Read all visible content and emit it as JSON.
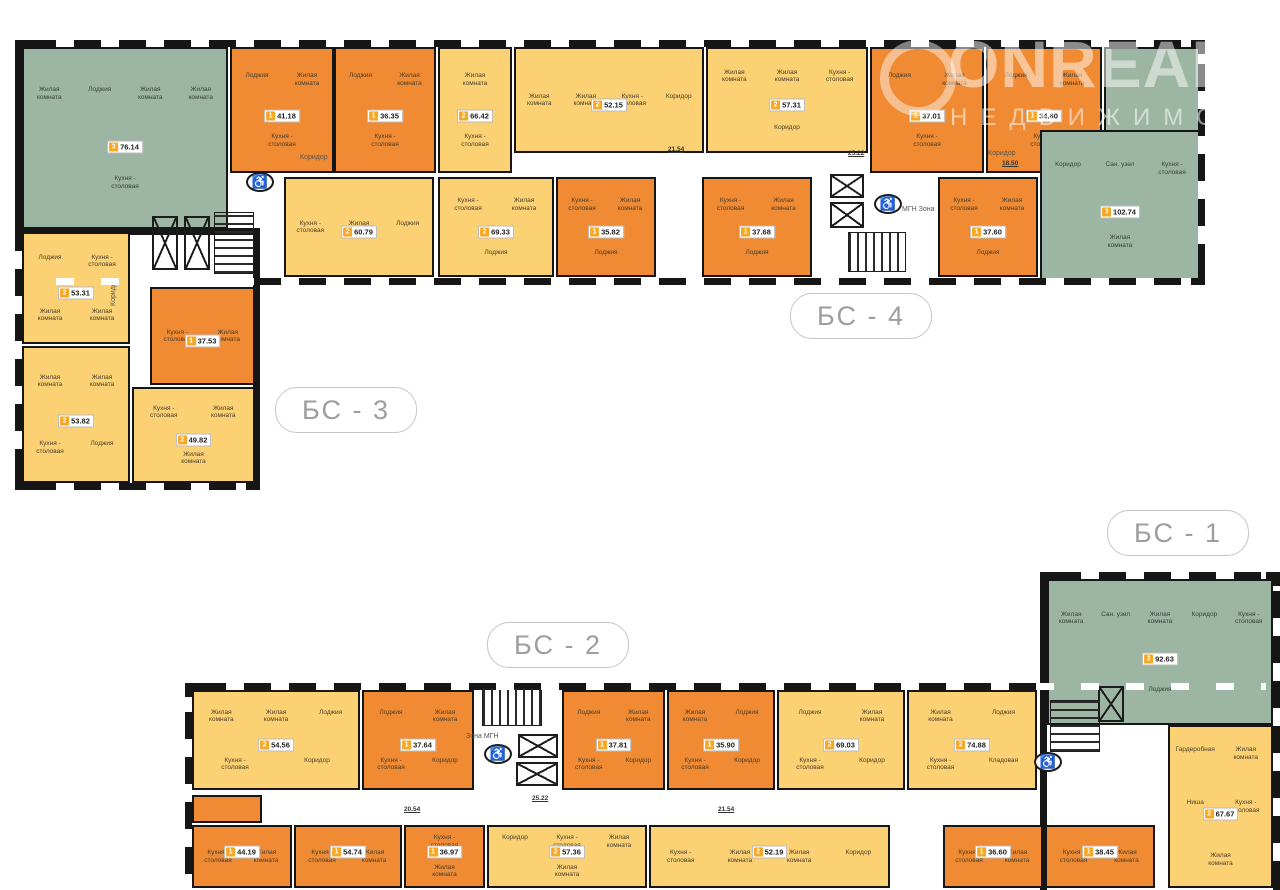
{
  "watermark": {
    "line1": "ONREALT",
    "line2": "НЕДВИЖИМОСТЬ"
  },
  "sections": [
    {
      "id": "bs4",
      "label": "БС - 4"
    },
    {
      "id": "bs3",
      "label": "БС - 3"
    },
    {
      "id": "bs2",
      "label": "БС - 2"
    },
    {
      "id": "bs1",
      "label": "БС - 1"
    }
  ],
  "colors": {
    "one_room": "#f08b33",
    "two_room": "#fcd173",
    "three_room": "#9db5a3",
    "wall": "#161616",
    "badge_square": "#f7a823"
  },
  "apartments": [
    {
      "id": "a7614",
      "section": "БС-3",
      "rooms_count": "3",
      "area": "76.14",
      "type": "three_room",
      "rooms": [
        "Жилая комната",
        "Лоджия",
        "Жилая комната",
        "Жилая комната",
        "Кухня - столовая"
      ]
    },
    {
      "id": "a4118",
      "section": "БС-4",
      "rooms_count": "1",
      "area": "41.18",
      "type": "one_room",
      "rooms": [
        "Лоджия",
        "Жилая комната",
        "Кухня - столовая"
      ]
    },
    {
      "id": "a3635",
      "section": "БС-4",
      "rooms_count": "1",
      "area": "36.35",
      "type": "one_room",
      "rooms": [
        "Лоджия",
        "Жилая комната",
        "Кухня - столовая"
      ]
    },
    {
      "id": "a6642",
      "section": "БС-4",
      "rooms_count": "2",
      "area": "66.42",
      "type": "two_room",
      "rooms": [
        "Жилая комната",
        "Кухня - столовая"
      ]
    },
    {
      "id": "a5215",
      "section": "БС-4",
      "rooms_count": "2",
      "area": "52.15",
      "type": "two_room",
      "rooms": [
        "Жилая комната",
        "Жилая комната",
        "Кухня - столовая",
        "Коридор"
      ]
    },
    {
      "id": "a5731",
      "section": "БС-4",
      "rooms_count": "2",
      "area": "57.31",
      "type": "two_room",
      "rooms": [
        "Жилая комната",
        "Жилая комната",
        "Кухня - столовая",
        "Коридор"
      ]
    },
    {
      "id": "a3701",
      "section": "БС-4",
      "rooms_count": "1",
      "area": "37.01",
      "type": "one_room",
      "rooms": [
        "Лоджия",
        "Жилая комната",
        "Кухня - столовая"
      ]
    },
    {
      "id": "a3460",
      "section": "БС-4",
      "rooms_count": "1",
      "area": "34.60",
      "type": "one_room",
      "rooms": [
        "Лоджия",
        "Жилая комната",
        "Кухня - столовая"
      ]
    },
    {
      "id": "a10274",
      "section": "БС-4",
      "rooms_count": "3",
      "area": "102.74",
      "type": "three_room",
      "rooms": [
        "Коридор",
        "Сан. узел",
        "Кухня - столовая",
        "Жилая комната"
      ]
    },
    {
      "id": "a6079",
      "section": "БС-4",
      "rooms_count": "2",
      "area": "60.79",
      "type": "two_room",
      "rooms": [
        "Кухня - столовая",
        "Жилая комната",
        "Лоджия"
      ]
    },
    {
      "id": "a6933",
      "section": "БС-4",
      "rooms_count": "2",
      "area": "69.33",
      "type": "two_room",
      "rooms": [
        "Кухня - столовая",
        "Жилая комната",
        "Лоджия"
      ]
    },
    {
      "id": "a3582",
      "section": "БС-4",
      "rooms_count": "1",
      "area": "35.82",
      "type": "one_room",
      "rooms": [
        "Кухня - столовая",
        "Жилая комната",
        "Лоджия"
      ]
    },
    {
      "id": "a3768",
      "section": "БС-4",
      "rooms_count": "1",
      "area": "37.68",
      "type": "one_room",
      "rooms": [
        "Кухня - столовая",
        "Жилая комната",
        "Лоджия"
      ]
    },
    {
      "id": "a3760",
      "section": "БС-4",
      "rooms_count": "1",
      "area": "37.60",
      "type": "one_room",
      "rooms": [
        "Кухня - столовая",
        "Жилая комната",
        "Лоджия"
      ]
    },
    {
      "id": "a5331",
      "section": "БС-3",
      "rooms_count": "2",
      "area": "53.31",
      "type": "two_room",
      "rooms": [
        "Лоджия",
        "Кухня - столовая",
        "Жилая комната",
        "Жилая комната"
      ]
    },
    {
      "id": "a3753",
      "section": "БС-3",
      "rooms_count": "1",
      "area": "37.53",
      "type": "one_room",
      "rooms": [
        "Кухня - столовая",
        "Жилая комната"
      ]
    },
    {
      "id": "a5382",
      "section": "БС-3",
      "rooms_count": "2",
      "area": "53.82",
      "type": "two_room",
      "rooms": [
        "Жилая комната",
        "Жилая комната",
        "Кухня - столовая",
        "Лоджия"
      ]
    },
    {
      "id": "a4982",
      "section": "БС-3",
      "rooms_count": "2",
      "area": "49.82",
      "type": "two_room",
      "rooms": [
        "Кухня - столовая",
        "Жилая комната",
        "Жилая комната"
      ]
    },
    {
      "id": "a5456",
      "section": "БС-2",
      "rooms_count": "2",
      "area": "54.56",
      "type": "two_room",
      "rooms": [
        "Жилая комната",
        "Жилая комната",
        "Лоджия",
        "Кухня - столовая",
        "Коридор"
      ]
    },
    {
      "id": "a3764",
      "section": "БС-2",
      "rooms_count": "1",
      "area": "37.64",
      "type": "one_room",
      "rooms": [
        "Лоджия",
        "Жилая комната",
        "Кухня - столовая",
        "Коридор"
      ]
    },
    {
      "id": "a3781",
      "section": "БС-2",
      "rooms_count": "1",
      "area": "37.81",
      "type": "one_room",
      "rooms": [
        "Лоджия",
        "Жилая комната",
        "Кухня - столовая",
        "Коридор"
      ]
    },
    {
      "id": "a3590",
      "section": "БС-2",
      "rooms_count": "1",
      "area": "35.90",
      "type": "one_room",
      "rooms": [
        "Жилая комната",
        "Лоджия",
        "Кухня - столовая",
        "Коридор"
      ]
    },
    {
      "id": "a6903",
      "section": "БС-2",
      "rooms_count": "2",
      "area": "69.03",
      "type": "two_room",
      "rooms": [
        "Лоджия",
        "Жилая комната",
        "Кухня - столовая",
        "Коридор"
      ]
    },
    {
      "id": "a7488",
      "section": "БС-2",
      "rooms_count": "2",
      "area": "74.88",
      "type": "two_room",
      "rooms": [
        "Жилая комната",
        "Лоджия",
        "Кухня - столовая",
        "Кладовая"
      ]
    },
    {
      "id": "a4419",
      "section": "БС-2",
      "rooms_count": "1",
      "area": "44.19",
      "type": "one_room",
      "rooms": [
        "Кухня - столовая",
        "Жилая комната"
      ]
    },
    {
      "id": "a5474",
      "section": "БС-2",
      "rooms_count": "1",
      "area": "54.74",
      "type": "one_room",
      "rooms": [
        "Кухня - столовая",
        "Жилая комната"
      ]
    },
    {
      "id": "a3697",
      "section": "БС-2",
      "rooms_count": "1",
      "area": "36.97",
      "type": "one_room",
      "rooms": [
        "Кухня - столовая",
        "Жилая комната"
      ]
    },
    {
      "id": "a5736",
      "section": "БС-2",
      "rooms_count": "2",
      "area": "57.36",
      "type": "two_room",
      "rooms": [
        "Коридор",
        "Кухня - столовая",
        "Жилая комната",
        "Жилая комната"
      ]
    },
    {
      "id": "a5219",
      "section": "БС-2",
      "rooms_count": "2",
      "area": "52.19",
      "type": "two_room",
      "rooms": [
        "Кухня - столовая",
        "Жилая комната",
        "Жилая комната",
        "Коридор"
      ]
    },
    {
      "id": "a3660",
      "section": "БС-2",
      "rooms_count": "1",
      "area": "36.60",
      "type": "one_room",
      "rooms": [
        "Кухня - столовая",
        "Жилая комната"
      ]
    },
    {
      "id": "a3845",
      "section": "БС-2",
      "rooms_count": "1",
      "area": "38.45",
      "type": "one_room",
      "rooms": [
        "Кухня - столовая",
        "Жилая комната"
      ]
    },
    {
      "id": "a9263",
      "section": "БС-1",
      "rooms_count": "3",
      "area": "92.63",
      "type": "three_room",
      "rooms": [
        "Жилая комната",
        "Сан. узел",
        "Жилая комната",
        "Коридор",
        "Кухня - столовая",
        "Лоджия"
      ]
    },
    {
      "id": "a6767",
      "section": "БС-1",
      "rooms_count": "2",
      "area": "67.67",
      "type": "two_room",
      "rooms": [
        "Гардеробная",
        "Жилая комната",
        "Ниша",
        "Кухня - столовая",
        "Жилая комната"
      ]
    }
  ],
  "floating_labels": [
    {
      "id": "kor-bs4",
      "text": "Коридор",
      "kind": "kor"
    },
    {
      "id": "kor-bs4r",
      "text": "Коридор",
      "kind": "kor"
    },
    {
      "id": "kor-bs3",
      "text": "Коридор",
      "kind": "kor"
    },
    {
      "id": "dim1",
      "text": "21.54",
      "kind": "dim"
    },
    {
      "id": "dim2",
      "text": "25.22",
      "kind": "dim"
    },
    {
      "id": "dim3",
      "text": "18.50",
      "kind": "dim"
    },
    {
      "id": "dim4",
      "text": "20.54",
      "kind": "dim"
    },
    {
      "id": "dim5",
      "text": "25.22",
      "kind": "dim"
    },
    {
      "id": "dim6",
      "text": "21.54",
      "kind": "dim"
    },
    {
      "id": "mgn-bs4",
      "text": "МГН Зона",
      "kind": "mgnlbl"
    },
    {
      "id": "mgn-bs2",
      "text": "Зона МГН",
      "kind": "mgnlbl"
    }
  ],
  "icon_glyphs": {
    "wheelchair": "♿"
  }
}
